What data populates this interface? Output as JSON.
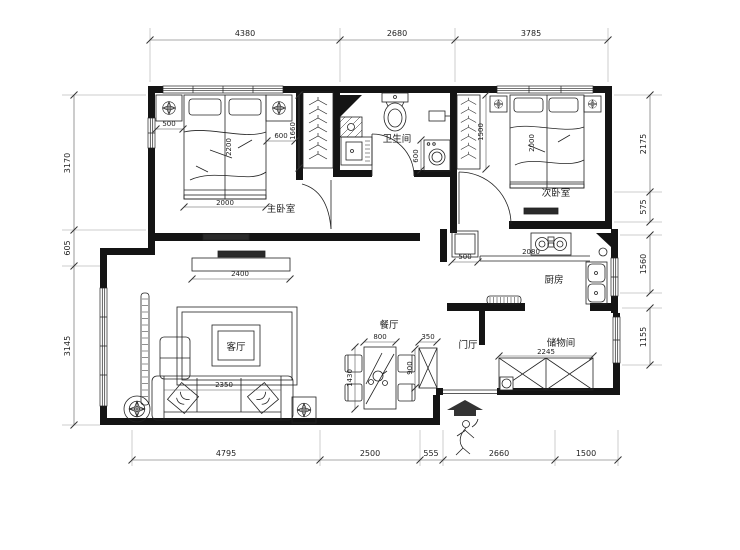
{
  "drawing": {
    "rooms": {
      "master_bedroom": "主卧室",
      "secondary_bedroom": "次卧室",
      "bathroom": "卫生间",
      "kitchen": "厨房",
      "living_room": "客厅",
      "dining_room": "餐厅",
      "foyer": "门厅",
      "storage_room": "储物间"
    },
    "dims": {
      "top": [
        "4380",
        "2680",
        "3785"
      ],
      "bottom": [
        "4795",
        "2500",
        "555",
        "2660",
        "1500"
      ],
      "left": [
        "3170",
        "605",
        "3145"
      ],
      "right": [
        "2175",
        "575",
        "1560",
        "1155"
      ],
      "master_nightstand_left": "500",
      "master_nightstand_right": "600",
      "master_wardrobe": "1660",
      "master_bed_width": "2000",
      "master_bed_length": "2200",
      "washer": "600",
      "secondary_wardrobe": "1500",
      "secondary_bed_length": "2000",
      "fridge": "500",
      "kitchen_counter": "2080",
      "tv_cabinet": "2400",
      "sofa": "2350",
      "dining_table_width": "800",
      "dining_table_length": "1430",
      "foyer_cabinet_width": "350",
      "foyer_cabinet_depth": "900",
      "storage_cabinet": "2245"
    },
    "colors": {
      "wall": "#141414",
      "line": "#222222",
      "dim": "#444444"
    }
  }
}
